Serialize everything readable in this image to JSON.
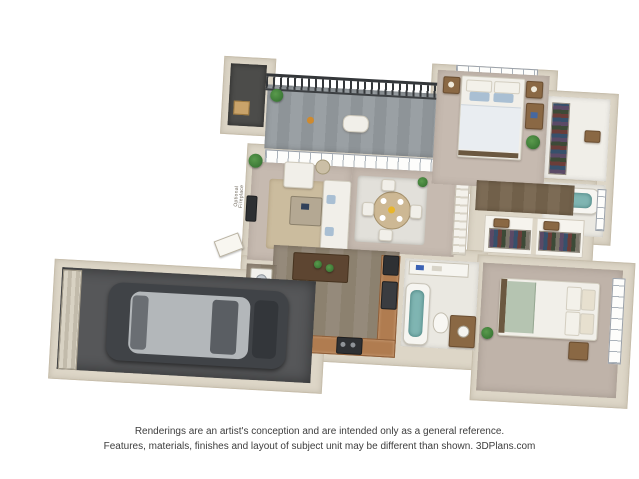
{
  "canvas": {
    "width": 639,
    "height": 479,
    "background": "#ffffff"
  },
  "disclaimer": {
    "line1": "Renderings are an artist's conception and are intended only as a general reference.",
    "line2": "Features, materials, finishes and layout of subject unit may be different than shown. 3DPlans.com"
  },
  "plan": {
    "annotations": {
      "optional_fireplace": "Optional Fireplace"
    },
    "palette": {
      "wall": "#ddd6c7",
      "wall_edge": "#c6bdab",
      "carpet": "#c6bab0",
      "kitchen_wood": "#958a7b",
      "hall_wood": "#7c6b55",
      "balcony_deck": "#9aa0a4",
      "railing": "#34373a",
      "garage_floor": "#565759",
      "counter": "#b07c50",
      "appliance": "#2e3033",
      "bath_water": "#7fb5b2",
      "living_rug": "#cbbc9e",
      "dining_rug": "#e2e0da",
      "master_bed_accent": "#a9bfd3",
      "bedroom2_accent": "#b5c4b1",
      "plant_green": "#3e7d3a",
      "car_body": "#404347",
      "car_roof": "#b3b7ba"
    },
    "rooms": [
      {
        "id": "balcony",
        "name": "Balcony",
        "features": [
          "railing",
          "plank deck",
          "potted plant",
          "lounge chair"
        ]
      },
      {
        "id": "storage",
        "name": "Storage closet",
        "features": [
          "storage box"
        ]
      },
      {
        "id": "living",
        "name": "Living room",
        "features": [
          "sofa",
          "armchair",
          "coffee table",
          "area rug",
          "wall tv",
          "optional fireplace",
          "plant"
        ]
      },
      {
        "id": "dining",
        "name": "Dining area",
        "features": [
          "round table",
          "four chairs",
          "place settings",
          "rug",
          "cactus"
        ]
      },
      {
        "id": "master-bedroom",
        "name": "Master bedroom",
        "features": [
          "bed with blue pillows",
          "two nightstands",
          "desk",
          "plant",
          "windows over headboard"
        ]
      },
      {
        "id": "walk-in-closet",
        "name": "Walk-in closet",
        "features": [
          "hanging clothes"
        ]
      },
      {
        "id": "master-bath",
        "name": "Master bathroom",
        "features": [
          "soaking tub",
          "window"
        ]
      },
      {
        "id": "hallway",
        "name": "Hallway",
        "features": [
          "wood floor",
          "linen closets",
          "white built-ins"
        ]
      },
      {
        "id": "kitchen",
        "name": "Kitchen",
        "features": [
          "L-shaped counter",
          "island with produce",
          "refrigerator",
          "range",
          "wood floor"
        ]
      },
      {
        "id": "laundry",
        "name": "Laundry nook",
        "features": [
          "washer"
        ]
      },
      {
        "id": "bath2",
        "name": "Second bathroom",
        "features": [
          "tub",
          "toilet",
          "vanity with sink"
        ]
      },
      {
        "id": "bedroom2",
        "name": "Second bedroom",
        "features": [
          "bed with sage blanket",
          "nightstand",
          "corner windows",
          "plant"
        ]
      },
      {
        "id": "garage",
        "name": "Attached garage",
        "features": [
          "sedan car",
          "ribbed garage door"
        ]
      },
      {
        "id": "entry",
        "name": "Entry",
        "features": [
          "front door",
          "wood floor"
        ]
      }
    ]
  }
}
